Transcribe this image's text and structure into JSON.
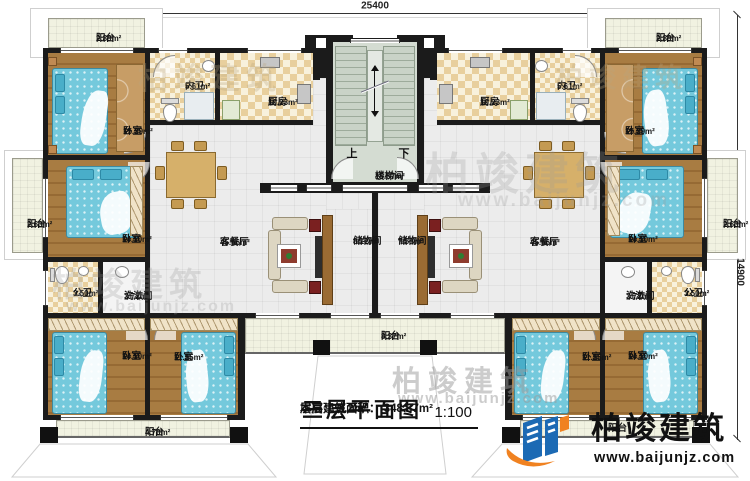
{
  "dimensions": {
    "top": "25400",
    "right": "14900"
  },
  "stair": {
    "up": "上",
    "down": "下"
  },
  "rooms": {
    "balcony_tl": {
      "name": "阳台",
      "area": "2.89m²"
    },
    "bedroom_tl": {
      "name": "卧室",
      "area": "15.29m²"
    },
    "bath_inner_l": {
      "name": "内卫",
      "area": "5.61m²"
    },
    "kitchen_l": {
      "name": "厨房",
      "area": "10.23m²"
    },
    "balcony_l": {
      "name": "阳台",
      "area": "2.63m²"
    },
    "bedroom_ml": {
      "name": "卧室",
      "area": "14.10m²"
    },
    "pubbath_l": {
      "name": "公卫",
      "area": "3.50m²"
    },
    "wash_l": {
      "name": "洗漱间",
      "area": "3.72m²"
    },
    "living_l": {
      "name": "客餐厅",
      "area": "45.66m²"
    },
    "storage_l": {
      "name": "储物间",
      "area": "8.12m²"
    },
    "bedroom_bl": {
      "name": "卧室",
      "area": "14.10m²"
    },
    "bedroom_bl2": {
      "name": "卧室",
      "area": "11.25m²"
    },
    "balcony_bl": {
      "name": "阳台",
      "area": "4.70m²"
    },
    "stairwell": {
      "name": "楼梯间",
      "area": "15.67m²"
    },
    "balcony_bc": {
      "name": "阳台",
      "area": "8.37m²"
    },
    "balcony_tr": {
      "name": "阳台",
      "area": "2.89m²"
    },
    "bedroom_tr": {
      "name": "卧室",
      "area": "15.29m²"
    },
    "bath_inner_r": {
      "name": "内卫",
      "area": "5.61m²"
    },
    "kitchen_r": {
      "name": "厨房",
      "area": "10.23m²"
    },
    "balcony_r": {
      "name": "阳台",
      "area": "2.63m²"
    },
    "bedroom_mr": {
      "name": "卧室",
      "area": "14.10m²"
    },
    "wash_r": {
      "name": "洗漱间",
      "area": "3.72m²"
    },
    "pubbath_r": {
      "name": "公卫",
      "area": "3.50m²"
    },
    "living_r": {
      "name": "客餐厅",
      "area": "45.66m²"
    },
    "storage_r": {
      "name": "储物间",
      "area": "7.58m²"
    },
    "bedroom_br2": {
      "name": "卧室",
      "area": "11.25m²"
    },
    "bedroom_br": {
      "name": "卧室",
      "area": "14.10m²"
    },
    "balcony_br": {
      "name": "阳台",
      "area": ""
    }
  },
  "title_block": {
    "title": "三层平面图",
    "scale": "1:100",
    "area_label": "本层建筑面积：",
    "area_value": "348.37m²",
    "height_label": "层高：",
    "height_value": "3.2m"
  },
  "logo": {
    "brand": "柏竣建筑",
    "website": "www.baijunjz.com"
  },
  "watermark": {
    "brand": "柏竣建筑",
    "website": "www.baijunjz.com"
  },
  "colors": {
    "wall": "#1b1b1b",
    "bedroom_floor": "#a1723c",
    "tile": "#e8cf9d",
    "living_floor": "#ececec",
    "balcony_floor": "#f1f2e1",
    "stair_floor": "#d4dcd2",
    "bed_blue": "#74c9dc",
    "wood": "#9a6b33",
    "logo_blue": "#1c6ab4",
    "logo_orange": "#f08221"
  }
}
